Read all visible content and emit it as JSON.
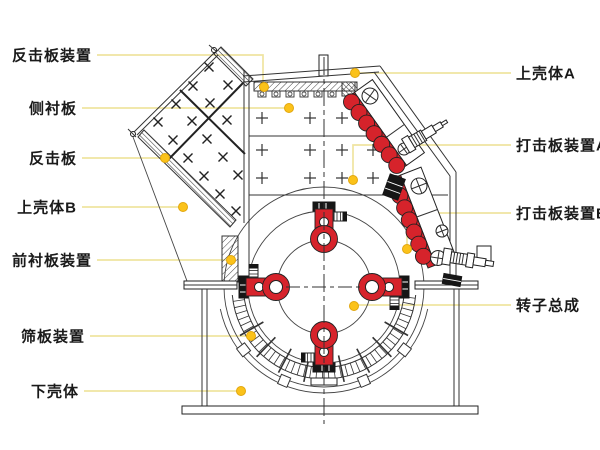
{
  "diagram": {
    "colors": {
      "background": "#ffffff",
      "outline": "#333333",
      "part_red": "#d6232b",
      "leader_line": "#efe4a0",
      "leader_dot": "#fbc21a",
      "leader_dot_edge": "#e2a70e",
      "label_text": "#1a1a1a"
    },
    "labels": [
      {
        "text": "反击板装置",
        "side": "left",
        "line": [
          [
            97,
            55
          ],
          [
            263,
            55
          ],
          [
            263,
            84
          ]
        ],
        "dot": [
          264,
          87
        ]
      },
      {
        "text": "侧衬板",
        "side": "left",
        "line": [
          [
            82,
            108
          ],
          [
            288,
            108
          ]
        ],
        "dot": [
          289,
          108
        ]
      },
      {
        "text": "反击板",
        "side": "left",
        "line": [
          [
            82,
            158
          ],
          [
            163,
            158
          ]
        ],
        "dot": [
          165,
          158
        ]
      },
      {
        "text": "上壳体B",
        "side": "left",
        "line": [
          [
            82,
            207
          ],
          [
            181,
            207
          ]
        ],
        "dot": [
          183,
          207
        ]
      },
      {
        "text": "前衬板装置",
        "side": "left",
        "line": [
          [
            97,
            260
          ],
          [
            229,
            260
          ]
        ],
        "dot": [
          231,
          260
        ]
      },
      {
        "text": "筛板装置",
        "side": "left",
        "line": [
          [
            90,
            336
          ],
          [
            249,
            336
          ]
        ],
        "dot": [
          251,
          336
        ]
      },
      {
        "text": "下壳体",
        "side": "left",
        "line": [
          [
            84,
            391
          ],
          [
            239,
            391
          ]
        ],
        "dot": [
          241,
          391
        ]
      },
      {
        "text": "上壳体A",
        "side": "right",
        "line": [
          [
            511,
            73
          ],
          [
            357,
            73
          ]
        ],
        "dot": [
          355,
          73
        ]
      },
      {
        "text": "打击板装置A",
        "side": "right",
        "line": [
          [
            511,
            145
          ],
          [
            353,
            145
          ],
          [
            353,
            177
          ]
        ],
        "dot": [
          353,
          180
        ]
      },
      {
        "text": "打击板装置B",
        "side": "right",
        "line": [
          [
            511,
            213
          ],
          [
            407,
            213
          ],
          [
            407,
            246
          ]
        ],
        "dot": [
          407,
          249
        ]
      },
      {
        "text": "转子总成",
        "side": "right",
        "line": [
          [
            511,
            305
          ],
          [
            356,
            305
          ]
        ],
        "dot": [
          354,
          306
        ]
      }
    ]
  }
}
